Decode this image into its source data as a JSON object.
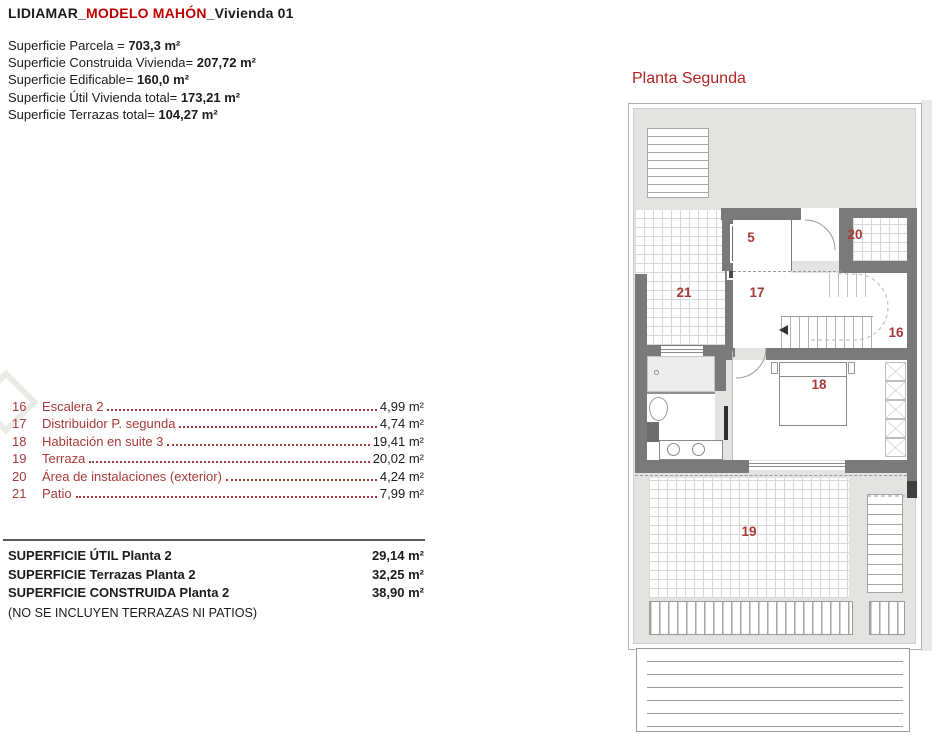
{
  "header": {
    "brand": "LIDIAMAR_",
    "model": "MODELO MAHÓN",
    "unit": "_Vivienda 01"
  },
  "top_summary": [
    {
      "label": "Superficie Parcela = ",
      "value": "703,3 m²"
    },
    {
      "label": "Superficie Construida Vivienda= ",
      "value": "207,72 m²"
    },
    {
      "label": "Superficie Edificable= ",
      "value": "160,0 m²"
    },
    {
      "label": "Superficie Útil Vivienda total= ",
      "value": "173,21 m²"
    },
    {
      "label": "Superficie Terrazas total= ",
      "value": "104,27 m²"
    }
  ],
  "plan": {
    "title": "Planta Segunda",
    "labels": {
      "r5": "5",
      "r16": "16",
      "r17": "17",
      "r18": "18",
      "r19": "19",
      "r20": "20",
      "r21": "21"
    }
  },
  "room_list": [
    {
      "num": "16",
      "name": "Escalera 2",
      "area": "4,99 m²"
    },
    {
      "num": "17",
      "name": "Distribuidor P. segunda",
      "area": "4,74 m²"
    },
    {
      "num": "18",
      "name": "Habitación en suite 3",
      "area": "19,41 m²"
    },
    {
      "num": "19",
      "name": "Terraza",
      "area": "20,02 m²"
    },
    {
      "num": "20",
      "name": "Área de instalaciones (exterior)",
      "area": "4,24 m²"
    },
    {
      "num": "21",
      "name": "Patio",
      "area": "7,99 m²"
    }
  ],
  "bottom_summary": {
    "rows": [
      {
        "label": "SUPERFICIE ÚTIL Planta 2",
        "value": "29,14 m²"
      },
      {
        "label": "SUPERFICIE Terrazas Planta 2",
        "value": "32,25 m²"
      },
      {
        "label": "SUPERFICIE CONSTRUIDA Planta 2",
        "value": "38,90 m²"
      }
    ],
    "note": "(NO SE INCLUYEN TERRAZAS NI PATIOS)"
  },
  "colors": {
    "title_red": "#c00000",
    "plan_title_red": "#b22424",
    "list_red": "#a83a3a",
    "wall_gray": "#7a7a7a",
    "roof_gray": "#e3e3e1"
  }
}
